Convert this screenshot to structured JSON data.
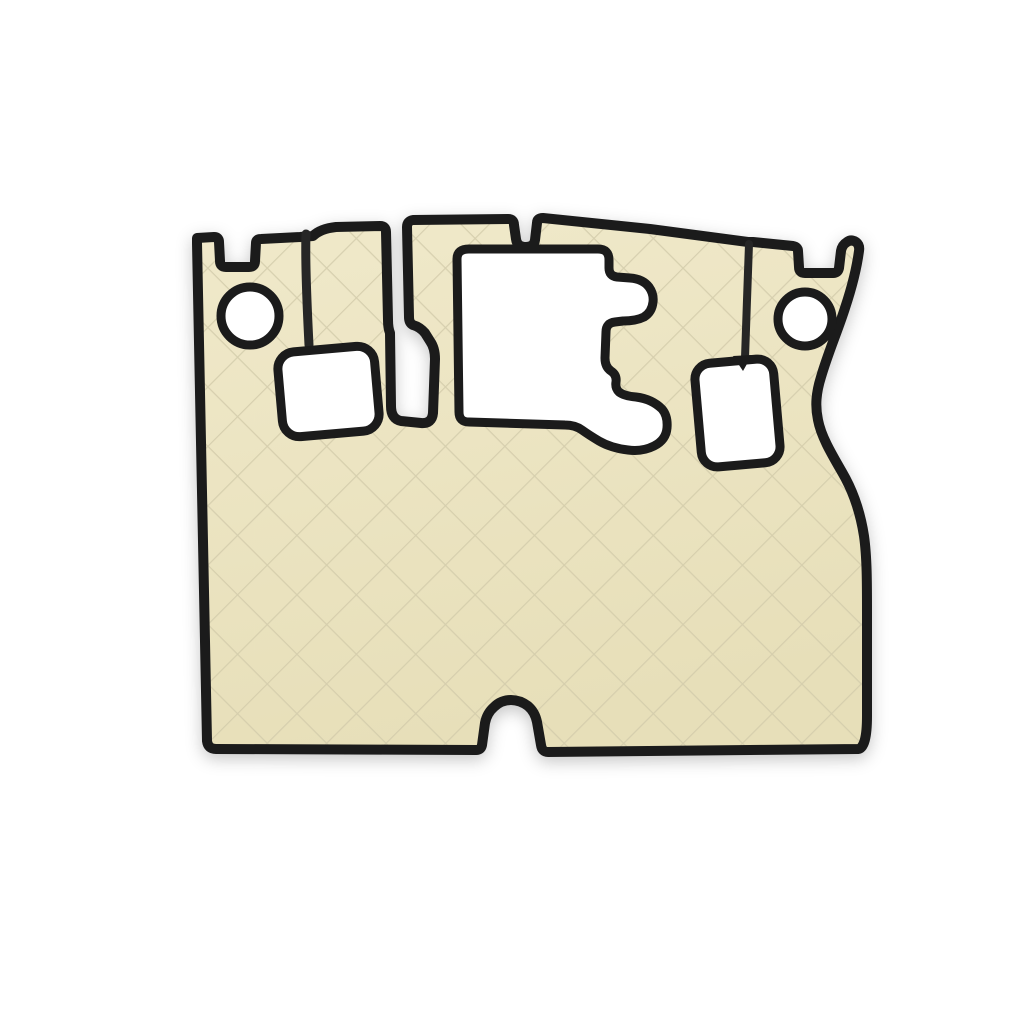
{
  "page": {
    "background": "#ffffff"
  },
  "product_image": {
    "alt": "Beige diamond-quilted truck floor mat set with black leatherette edging",
    "quilt_style": "diamond",
    "colors": {
      "background": "#ffffff",
      "mat_light": "#f0e9ca",
      "mat_dark": "#e7dfb9",
      "quilt_line": "#d2cbaa",
      "piping": "#1b1b1b",
      "piping_soft": "#262626",
      "cutout": "#ffffff"
    },
    "features": [
      "mounting-hole-left",
      "seat-base-cutout-left",
      "slot-cutout-center-left",
      "pedal-area-cutout",
      "gear-lever-cutout",
      "mounting-hole-right",
      "tunnel-notch-bottom"
    ]
  }
}
